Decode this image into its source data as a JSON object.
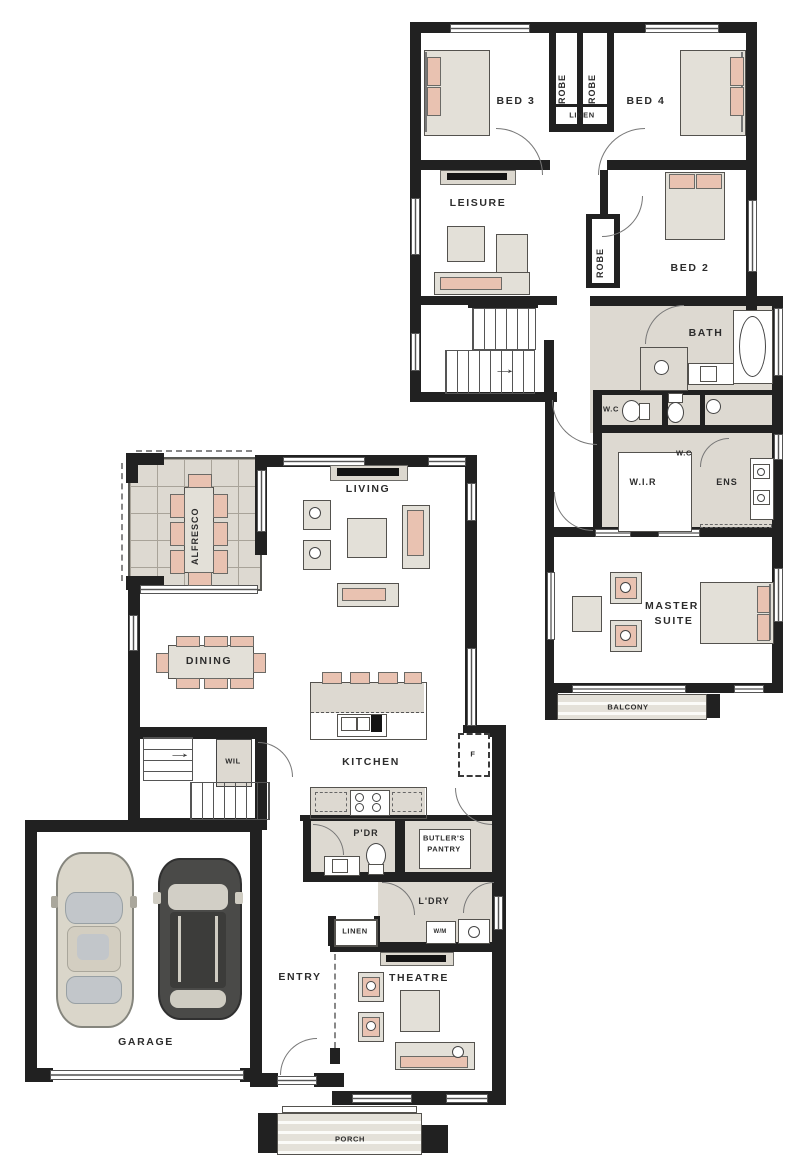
{
  "title": "Two storey house floor plan",
  "colors": {
    "wall": "#212121",
    "wet_area_beige": "#ddd9d1",
    "furniture_grey": "#e3e0d8",
    "accent_pink": "#e9c2b1",
    "paper": "#ffffff"
  },
  "upper": {
    "bed3": "BED 3",
    "bed4": "BED 4",
    "bed2": "BED 2",
    "robe1": "ROBE",
    "robe2": "ROBE",
    "robe3": "ROBE",
    "linen": "LINEN",
    "leisure": "LEISURE",
    "bath": "BATH",
    "wc1": "W.C",
    "wc2": "W.C",
    "wir": "W.I.R",
    "ens": "ENS",
    "master1": "MASTER",
    "master2": "SUITE",
    "balcony": "BALCONY",
    "stairs_arrow": "→"
  },
  "ground": {
    "alfresco": "ALFRESCO",
    "living": "LIVING",
    "dining": "DINING",
    "kitchen": "KITCHEN",
    "wil": "WIL",
    "pdr": "P'DR",
    "butlers1": "BUTLER'S",
    "butlers2": "PANTRY",
    "fridge": "F",
    "ldry": "L'DRY",
    "linen": "LINEN",
    "wm": "W/M",
    "entry": "ENTRY",
    "theatre": "THEATRE",
    "garage": "GARAGE",
    "porch": "PORCH",
    "stairs_arrow": "→"
  }
}
